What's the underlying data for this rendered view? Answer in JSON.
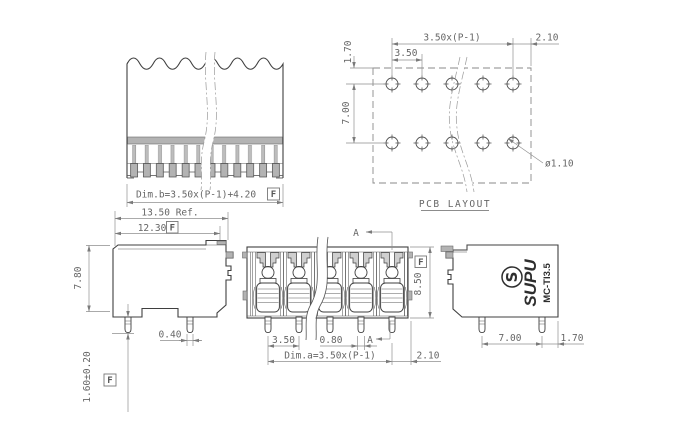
{
  "flag_symbol": "F",
  "colors": {
    "background": "#ffffff",
    "line": "#3f3f3f",
    "dimension_line": "#8f8f8f",
    "text": "#666666",
    "fill_gray": "#b3b3b3"
  },
  "views": {
    "broken_front": {
      "dim_b": "Dim.b=3.50x(P-1)+4.20"
    },
    "pcb_layout": {
      "title": "PCB LAYOUT",
      "pitch_total": "3.50x(P-1)",
      "end_margin": "2.10",
      "row_offset": "1.70",
      "pitch": "3.50",
      "row_spacing": "7.00",
      "hole_diameter": "ø1.10"
    },
    "side_left": {
      "ref_width": "13.50 Ref.",
      "body_width": "12.30",
      "height": "7.80",
      "pin_width": "0.40",
      "pin_length": "1.60±0.20"
    },
    "front": {
      "section_label": "A",
      "height": "8.50",
      "pitch": "3.50",
      "pin_width": "0.80",
      "dim_a": "Dim.a=3.50x(P-1)",
      "end_margin": "2.10"
    },
    "side_right": {
      "brand": "SUPU",
      "logo_letter": "S",
      "model": "MC-TI3.5",
      "pin_span": "7.00",
      "end_margin": "1.70"
    }
  }
}
